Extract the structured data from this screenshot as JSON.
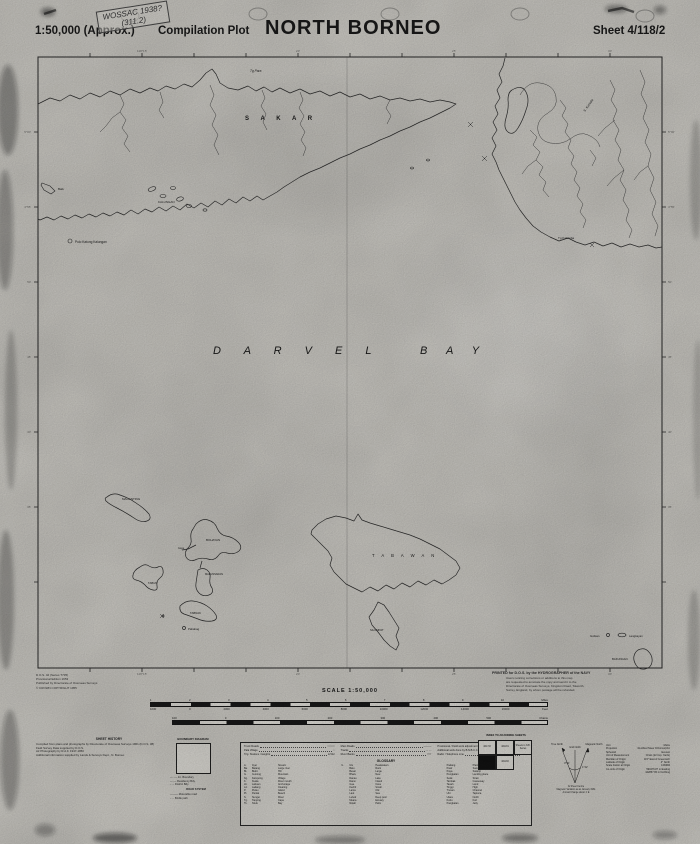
{
  "header": {
    "scale": "1:50,000 (Approx.)",
    "plot_type": "Compilation Plot",
    "title": "NORTH BORNEO",
    "sheet": "Sheet 4/118/2",
    "stamp": {
      "line1": "WOSSAC 1938?",
      "line2": "(311.2)"
    }
  },
  "map": {
    "labels": {
      "sakar": "S A K A R",
      "tg_para": "Tg Para",
      "kalungan": "KALUNGAN",
      "pulo_katung": "Pulo Katung Kalungan",
      "baik": "Baik",
      "s_kumala": "S. Kumala",
      "tg_kalumba": "Tg Kalumba",
      "darvel": "D A R V E L",
      "bay": "B A Y",
      "maganting": "MAGANTING",
      "bohayan": "BOHAYAN",
      "gaya": "Gaya",
      "tabun": "TABUN",
      "malunsaran": "MALUNSARAN",
      "tabnak": "TABNAK",
      "pababag": "Pababag",
      "tabawan": "T A B A W A N",
      "silumpat": "SILUMPAT",
      "gulisan": "Gulisan",
      "langkayan": "Langkayan",
      "bakungan": "BAKUNGAN"
    },
    "graticule_top": [
      "118°15'",
      "20'",
      "25'",
      "30'"
    ],
    "graticule_left": [
      "5°00'",
      "4°55'",
      "50'",
      "45'",
      "40'",
      "35'"
    ]
  },
  "footer": {
    "imprint": [
      "D.O.S. 42 (Series T735)",
      "Provisional Edition 1953",
      "Published by Directorate of Overseas Surveys",
      "© CROWN COPYRIGHT 1955"
    ],
    "printed_title": "PRINTED for D.O.S. by the HYDROGRAPHER of the NAVY",
    "printed_lines": [
      "Users noticing corrections or additions to this map",
      "are requested to annotate the copy and send it to the",
      "Directorate of Overseas Surveys, Kingston Road, Tolworth,",
      "Surrey, England, by whom postage will be refunded."
    ],
    "scale_caption": "SCALE 1:50,000",
    "scalebar": {
      "miles": [
        "1",
        "2",
        "3",
        "4",
        "5",
        "6",
        "7",
        "8",
        "9",
        "10",
        "Miles"
      ],
      "feet": [
        "1000",
        "0",
        "2000",
        "4000",
        "6000",
        "8000",
        "10000",
        "12000",
        "14000",
        "16000",
        "Feet"
      ],
      "chains": [
        "100",
        "0",
        "100",
        "200",
        "300",
        "400",
        "500",
        "Chains"
      ]
    }
  },
  "legend": {
    "sheet_history": {
      "title": "SHEET HISTORY",
      "lines": [
        "Compiled from plans and photographs by Directorate of Overseas Surveys 1961 (D.O.S. 38)",
        "Field Survey Data supplied by D.O.S.",
        "Air Photography by R.A.F. 1947-1950",
        "Additional information supplied by Lands & Surveys Dept., N. Borneo"
      ]
    },
    "boundary": {
      "title": "BOUNDARY DIAGRAM",
      "items": [
        "—··—  Int. Boundary",
        "—·—  Residency Bdy.",
        "- - -  District Bdy."
      ],
      "road_title": "ROAD SYSTEM",
      "roads": [
        "———  Motorable road",
        "- - -  Bridle path"
      ]
    },
    "symbols": {
      "col1": [
        {
          "label": "Trunk Roads",
          "sym": "════"
        },
        {
          "label": "Pala Village",
          "sym": "○"
        },
        {
          "label": "Trig. Stations / Heights",
          "sym": "Δ 512"
        }
      ],
      "col2": [
        {
          "label": "Main Roads",
          "sym": "———"
        },
        {
          "label": "Tracks",
          "sym": "- - - -"
        },
        {
          "label": "River Banks",
          "sym": "≈≈≈"
        }
      ],
      "col3": [
        {
          "label": "Provisional / Field work adjustment",
          "sym": "500 m"
        },
        {
          "label": "Additional work done by B.N.B.C.C. 1948",
          "sym": "+ 1 km"
        },
        {
          "label": "Radio / Telephone Line",
          "sym": "—T—"
        }
      ]
    },
    "glossary": {
      "title": "GLOSSARY",
      "entries": [
        {
          "a": "A.",
          "m": "Ayer",
          "e": "Stream"
        },
        {
          "a": "Ba.",
          "m": "Batang",
          "e": "Large river"
        },
        {
          "a": "Bt.",
          "m": "Bukit",
          "e": "Hill"
        },
        {
          "a": "G.",
          "m": "Gunong",
          "e": "Mountain"
        },
        {
          "a": "Kg.",
          "m": "Kampong",
          "e": "Village"
        },
        {
          "a": "K.",
          "m": "Kuala",
          "e": "River mouth"
        },
        {
          "a": "Lb.",
          "m": "Labuan",
          "e": "Anchorage"
        },
        {
          "a": "Ld.",
          "m": "Ladang",
          "e": "Clearing"
        },
        {
          "a": "P.",
          "m": "Pulau",
          "e": "Island"
        },
        {
          "a": "Pt.",
          "m": "Pantai",
          "e": "Beach"
        },
        {
          "a": "S.",
          "m": "Sungei",
          "e": "River"
        },
        {
          "a": "Tg.",
          "m": "Tanjong",
          "e": "Cape"
        },
        {
          "a": "Tk.",
          "m": "Telok",
          "e": "Bay"
        },
        {
          "a": "U.",
          "m": "Ulu",
          "e": "Headwaters"
        },
        {
          "a": "",
          "m": "Batu",
          "e": "Rock"
        },
        {
          "a": "",
          "m": "Besar",
          "e": "Large"
        },
        {
          "a": "",
          "m": "Bharu",
          "e": "New"
        },
        {
          "a": "",
          "m": "Danau",
          "e": "Lake"
        },
        {
          "a": "",
          "m": "Darat",
          "e": "Inland"
        },
        {
          "a": "",
          "m": "Gua",
          "e": "Cave"
        },
        {
          "a": "",
          "m": "Kechil",
          "e": "Small"
        },
        {
          "a": "",
          "m": "Lama",
          "e": "Old"
        },
        {
          "a": "",
          "m": "Laut",
          "e": "Sea"
        },
        {
          "a": "",
          "m": "Lubok",
          "e": "Deep pool"
        },
        {
          "a": "",
          "m": "Muara",
          "e": "Estuary"
        },
        {
          "a": "",
          "m": "Nipah",
          "e": "Palm"
        },
        {
          "a": "",
          "m": "Padang",
          "e": "Plain"
        },
        {
          "a": "",
          "m": "Pasir",
          "e": "Sand"
        },
        {
          "a": "",
          "m": "Paya",
          "e": "Swamp"
        },
        {
          "a": "",
          "m": "Pengkalan",
          "e": "Landing place"
        },
        {
          "a": "",
          "m": "Selat",
          "e": "Strait"
        },
        {
          "a": "",
          "m": "Tambak",
          "e": "Causeway"
        },
        {
          "a": "",
          "m": "Tanah",
          "e": "Land"
        },
        {
          "a": "",
          "m": "Tinggi",
          "e": "High"
        },
        {
          "a": "",
          "m": "Trusan",
          "e": "Channel"
        },
        {
          "a": "",
          "m": "Ubi",
          "e": "Tapioca"
        },
        {
          "a": "",
          "m": "Utara",
          "e": "North"
        },
        {
          "a": "",
          "m": "Kubu",
          "e": "Fort"
        },
        {
          "a": "",
          "m": "Pangkalan",
          "e": "Jetty"
        }
      ]
    },
    "index": {
      "title": "INDEX TO ADJOINING SHEETS",
      "cells": [
        "4/117/2",
        "4/118/1",
        "Sheets in N.B. Series",
        "4/117/4",
        "4/118/2"
      ]
    },
    "compass": {
      "grid": "Grid North",
      "true_n": "True North",
      "magnetic": "Magnetic North",
      "a1": "0°51'",
      "a2": "1°42'",
      "notes": [
        "At Sheet Centre",
        "Magnetic Variation as at January 1961",
        "Annual Change about 1' E"
      ]
    },
    "projection": {
      "rows": [
        {
          "k": "Unit",
          "v": "Metre"
        },
        {
          "k": "Projection",
          "v": "Rectified Skew Orthomorphic"
        },
        {
          "k": "Spheroid",
          "v": "Everest"
        },
        {
          "k": "Unit of Measurement",
          "v": "Chain (22 Imp. Yards)"
        },
        {
          "k": "Meridian of Origin",
          "v": "115° East of Greenwich"
        },
        {
          "k": "Latitude of Origin",
          "v": "4° North"
        },
        {
          "k": "Scale Factor at Origin",
          "v": "0.99984"
        },
        {
          "k": "Co-ords of Origin",
          "v": "590476.87 m Easting"
        },
        {
          "k": "",
          "v": "442857.65 m Northing"
        }
      ]
    }
  },
  "colors": {
    "paper": "#d5d3cd",
    "ink": "#1b1b1b"
  }
}
